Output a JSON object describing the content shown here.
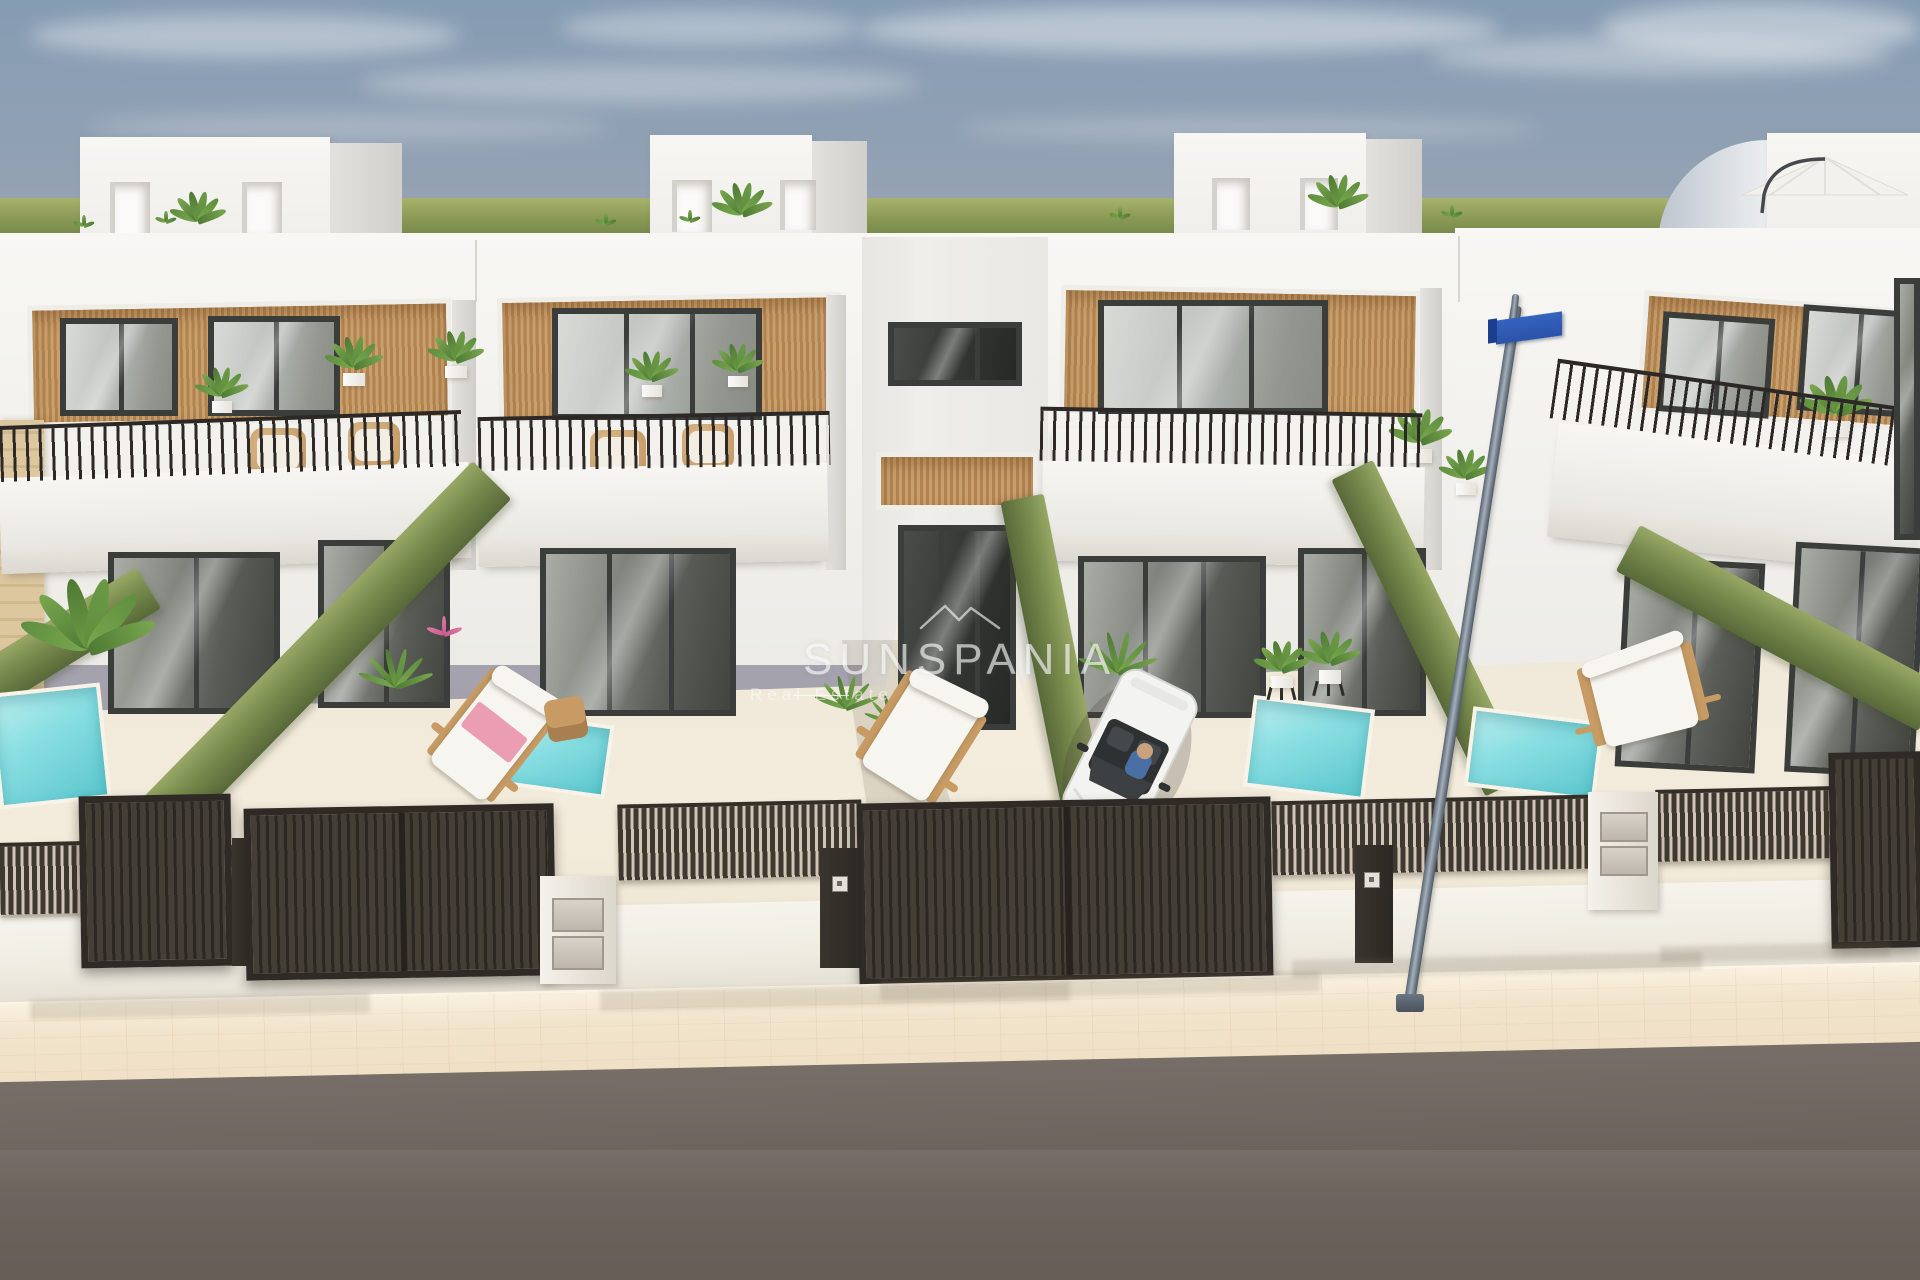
{
  "watermark": {
    "brand": "SUNSPANIA",
    "tagline": "Real Estate",
    "color_hex": "#ffffff",
    "logo": "roofline-icon"
  },
  "palette": {
    "sky_top": "#869cb3",
    "sky_haze": "#a29daa",
    "horizon_green": "#7d8d4e",
    "facade_white": "#f5f4f0",
    "wood_slat": "#c09263",
    "frame_dark": "#3a3d3a",
    "hedge_green": "#778a4c",
    "pool_turquoise": "#7cd9dd",
    "patio_cream": "#f0e9da",
    "fence_dark": "#38322c",
    "sidewalk_beige": "#f2e4cc",
    "road_gray": "#6b635c",
    "car_white": "#f3f3f1",
    "sign_blue": "#2e5ab4",
    "towel_pink": "#eb9db2"
  },
  "scene": {
    "greenband": [
      0,
      198,
      1920,
      56
    ],
    "clouds": [
      [
        30,
        14,
        430,
        44,
        0.45
      ],
      [
        360,
        64,
        560,
        40,
        0.35
      ],
      [
        860,
        6,
        640,
        48,
        0.5
      ],
      [
        1430,
        36,
        460,
        40,
        0.4
      ],
      [
        90,
        112,
        520,
        30,
        0.25
      ],
      [
        960,
        116,
        580,
        26,
        0.25
      ],
      [
        1600,
        2,
        320,
        54,
        0.5
      ],
      [
        560,
        10,
        300,
        36,
        0.4
      ]
    ],
    "building_base": [
      0,
      233,
      1920,
      432
    ],
    "building_right": [
      1455,
      228,
      465,
      490
    ],
    "seams": [
      [
        475,
        240,
        2,
        62
      ],
      [
        862,
        240,
        2,
        62
      ],
      [
        1046,
        240,
        2,
        62
      ],
      [
        1458,
        236,
        2,
        66
      ]
    ],
    "towers": [
      {
        "front": [
          80,
          137,
          250,
          113
        ],
        "side": [
          330,
          143,
          72,
          105
        ],
        "doors": [
          [
            110,
            182,
            40,
            58
          ],
          [
            242,
            182,
            40,
            52
          ]
        ],
        "plant": [
          198,
          242,
          48
        ]
      },
      {
        "front": [
          650,
          135,
          162,
          108
        ],
        "side": [
          812,
          141,
          55,
          100
        ],
        "doors": [
          [
            672,
            180,
            40,
            52
          ],
          [
            780,
            180,
            36,
            50
          ]
        ],
        "plant": [
          742,
          238,
          52
        ]
      },
      {
        "front": [
          1174,
          133,
          192,
          110
        ],
        "side": [
          1366,
          139,
          56,
          102
        ],
        "doors": [
          [
            1212,
            178,
            38,
            52
          ],
          [
            1300,
            178,
            38,
            52
          ]
        ],
        "plant": [
          1338,
          230,
          52
        ]
      },
      {
        "front": [
          1767,
          133,
          153,
          112
        ],
        "curved": [
          1658,
          140,
          110,
          105
        ]
      }
    ],
    "umbrella": {
      "canopy": [
        1740,
        163,
        158,
        40
      ],
      "pole": [
        1722,
        178,
        10,
        42
      ]
    },
    "roof_tufts": [
      [
        84,
        236
      ],
      [
        166,
        232
      ],
      [
        606,
        234
      ],
      [
        690,
        231
      ],
      [
        1120,
        228
      ],
      [
        1452,
        226
      ]
    ],
    "parapets": [
      [
        0,
        470,
        470,
        96,
        -2
      ],
      [
        478,
        466,
        350,
        98,
        -1
      ],
      [
        1042,
        464,
        382,
        100,
        1
      ],
      [
        1552,
        442,
        370,
        114,
        6
      ]
    ],
    "railings": [
      [
        0,
        418,
        462,
        56,
        -2
      ],
      [
        478,
        414,
        352,
        54,
        -1
      ],
      [
        1040,
        410,
        382,
        54,
        1
      ],
      [
        1552,
        384,
        368,
        60,
        8
      ]
    ],
    "woodbands": [
      [
        28,
        302,
        424,
        122,
        -1
      ],
      [
        498,
        295,
        345,
        125,
        -1
      ],
      [
        876,
        452,
        162,
        58,
        0
      ],
      [
        1060,
        288,
        360,
        128,
        1
      ],
      [
        1640,
        300,
        280,
        122,
        4
      ]
    ],
    "recess": [
      862,
      237,
      186,
      480
    ],
    "corner_shades": [
      [
        452,
        300,
        24,
        270
      ],
      [
        826,
        295,
        20,
        275
      ],
      [
        1420,
        288,
        22,
        282
      ]
    ],
    "stone_pillar": [
      0,
      420,
      44,
      300
    ],
    "windows": [
      {
        "r": [
          60,
          318,
          118,
          98
        ],
        "m": 1
      },
      {
        "r": [
          208,
          316,
          132,
          100
        ],
        "m": 1
      },
      {
        "r": [
          552,
          308,
          210,
          112
        ],
        "m": 2
      },
      {
        "r": [
          888,
          322,
          134,
          64
        ],
        "dk": 1,
        "m": 2
      },
      {
        "r": [
          1098,
          300,
          230,
          114
        ],
        "m": 2
      },
      {
        "r": [
          1660,
          315,
          112,
          100
        ],
        "rot": 4,
        "m": 1
      },
      {
        "r": [
          1800,
          308,
          112,
          106
        ],
        "rot": 4,
        "m": 1
      },
      {
        "r": [
          108,
          552,
          172,
          162
        ],
        "gf": 1,
        "m": 1
      },
      {
        "r": [
          318,
          540,
          132,
          168
        ],
        "gf": 1,
        "m": 1
      },
      {
        "r": [
          540,
          548,
          196,
          168
        ],
        "gf": 1,
        "m": 2
      },
      {
        "r": [
          1078,
          556,
          188,
          162
        ],
        "gf": 1,
        "m": 2
      },
      {
        "r": [
          1298,
          548,
          128,
          168
        ],
        "gf": 1,
        "m": 1
      },
      {
        "r": [
          1620,
          560,
          140,
          210
        ],
        "gf": 1,
        "rot": 3,
        "m": 1
      },
      {
        "r": [
          1790,
          545,
          130,
          230
        ],
        "gf": 1,
        "rot": 3,
        "m": 1
      },
      {
        "r": [
          898,
          525,
          118,
          205
        ],
        "gf": 1,
        "dk": 1,
        "m": 2
      },
      {
        "r": [
          1894,
          278,
          26,
          262
        ],
        "gf": 1
      }
    ],
    "sofas": [
      [
        1052,
        428,
        132,
        56
      ],
      [
        1235,
        420,
        118,
        54
      ]
    ],
    "sofa_table": [
      1188,
      468,
      48,
      30
    ],
    "chairs": [
      [
        250,
        428,
        56,
        48
      ],
      [
        348,
        422,
        52,
        46
      ],
      [
        590,
        430,
        56,
        48
      ],
      [
        682,
        424,
        52,
        46
      ]
    ],
    "terrace_plants": [
      [
        222,
        424,
        46
      ],
      [
        354,
        398,
        50
      ],
      [
        456,
        390,
        48
      ],
      [
        652,
        408,
        46
      ],
      [
        738,
        398,
        44
      ],
      [
        1420,
        476,
        54
      ],
      [
        1466,
        506,
        46
      ],
      [
        1836,
        452,
        62
      ]
    ],
    "ground": [
      0,
      650,
      1920,
      352
    ],
    "walkway": [
      838,
      558,
      252,
      400
    ],
    "walk_shadow": [
      842,
      640,
      150,
      300
    ],
    "hedges": [
      {
        "x1": 100,
        "y1": 880,
        "x2": 492,
        "y2": 480,
        "t": 54
      },
      {
        "x1": 1022,
        "y1": 498,
        "x2": 1096,
        "y2": 868,
        "t": 44
      },
      {
        "x1": 1352,
        "y1": 470,
        "x2": 1506,
        "y2": 786,
        "t": 46
      },
      {
        "x1": 1628,
        "y1": 548,
        "x2": 1930,
        "y2": 708,
        "t": 52
      },
      {
        "x1": -50,
        "y1": 710,
        "x2": 148,
        "y2": 588,
        "t": 48
      }
    ],
    "pools": [
      {
        "r": [
          -6,
          688,
          112,
          116
        ],
        "rot": -6
      },
      {
        "r": [
          504,
          718,
          106,
          74
        ],
        "rot": 8
      },
      {
        "r": [
          1248,
          702,
          122,
          92
        ],
        "rot": 7
      },
      {
        "r": [
          1468,
          714,
          132,
          80
        ],
        "rot": 7
      }
    ],
    "ground_plants": [
      {
        "x": 88,
        "y": 700,
        "s": 115,
        "v": "palm"
      },
      {
        "x": 396,
        "y": 712,
        "s": 56,
        "v": "fern"
      },
      {
        "x": 444,
        "y": 648,
        "s": 30,
        "v": "pink"
      },
      {
        "x": 846,
        "y": 730,
        "s": 48,
        "v": "fern"
      },
      {
        "x": 892,
        "y": 742,
        "s": 42,
        "v": "fern"
      },
      {
        "x": 1282,
        "y": 700,
        "s": 48,
        "v": "stand"
      },
      {
        "x": 1330,
        "y": 696,
        "s": 52,
        "v": "stand"
      },
      {
        "x": 1118,
        "y": 700,
        "s": 60,
        "v": "fern"
      }
    ],
    "loungers": [
      {
        "r": [
          444,
          676,
          96,
          118
        ],
        "rot": 38,
        "towel": 1
      },
      {
        "r": [
          868,
          682,
          106,
          110
        ],
        "rot": 32
      },
      {
        "r": [
          1576,
          650,
          134,
          88
        ],
        "rot": -14
      }
    ],
    "side_table": [
      546,
      698,
      40,
      42
    ],
    "car": {
      "r": [
        1072,
        668,
        116,
        172
      ],
      "rot": 26
    },
    "fence": {
      "wall": [
        -12,
        898,
        1944,
        92,
        -1.2
      ],
      "slat_segs": [
        [
          0,
          842,
          82,
          72
        ],
        [
          232,
          845,
          16,
          70
        ],
        [
          618,
          802,
          244,
          76
        ],
        [
          1272,
          798,
          318,
          74
        ],
        [
          1656,
          788,
          176,
          72
        ]
      ],
      "gates": [
        {
          "r": [
            80,
            795,
            152,
            172
          ]
        },
        {
          "r": [
            245,
            806,
            310,
            172
          ],
          "split": 1
        },
        {
          "r": [
            858,
            800,
            414,
            182
          ],
          "split": 1
        },
        {
          "r": [
            1830,
            752,
            92,
            196
          ]
        }
      ],
      "posts": [
        [
          232,
          838,
          18,
          128
        ],
        [
          820,
          848,
          42,
          120
        ],
        [
          1355,
          845,
          38,
          118
        ]
      ],
      "pillars": [
        [
          540,
          876,
          76,
          108
        ],
        [
          1588,
          792,
          70,
          118
        ]
      ],
      "uboxes": [
        [
          552,
          898,
          52,
          34
        ],
        [
          552,
          936,
          52,
          34
        ],
        [
          1600,
          812,
          48,
          30
        ],
        [
          1600,
          846,
          48,
          30
        ]
      ],
      "keypads": [
        [
          832,
          876,
          16,
          16
        ],
        [
          1364,
          872,
          16,
          16
        ]
      ]
    },
    "sidewalk": [
      -12,
      982,
      1950,
      88,
      -1.2
    ],
    "road": [
      -12,
      1062,
      1950,
      250,
      -1.2
    ],
    "road_fill": [
      0,
      1150,
      1920,
      130
    ],
    "sidewalk_shadows": [
      [
        30,
        996,
        340,
        20
      ],
      [
        600,
        986,
        470,
        20
      ],
      [
        880,
        976,
        440,
        20
      ],
      [
        1292,
        956,
        410,
        18
      ],
      [
        1660,
        944,
        230,
        16
      ]
    ],
    "lamp": {
      "x1": 1516,
      "y1": 306,
      "x2": 1409,
      "y2": 1002,
      "w": 11,
      "sign": [
        1496,
        316,
        66,
        24
      ],
      "stub": [
        1511,
        294,
        7,
        26
      ],
      "base": [
        1396,
        994,
        28,
        18
      ]
    }
  }
}
